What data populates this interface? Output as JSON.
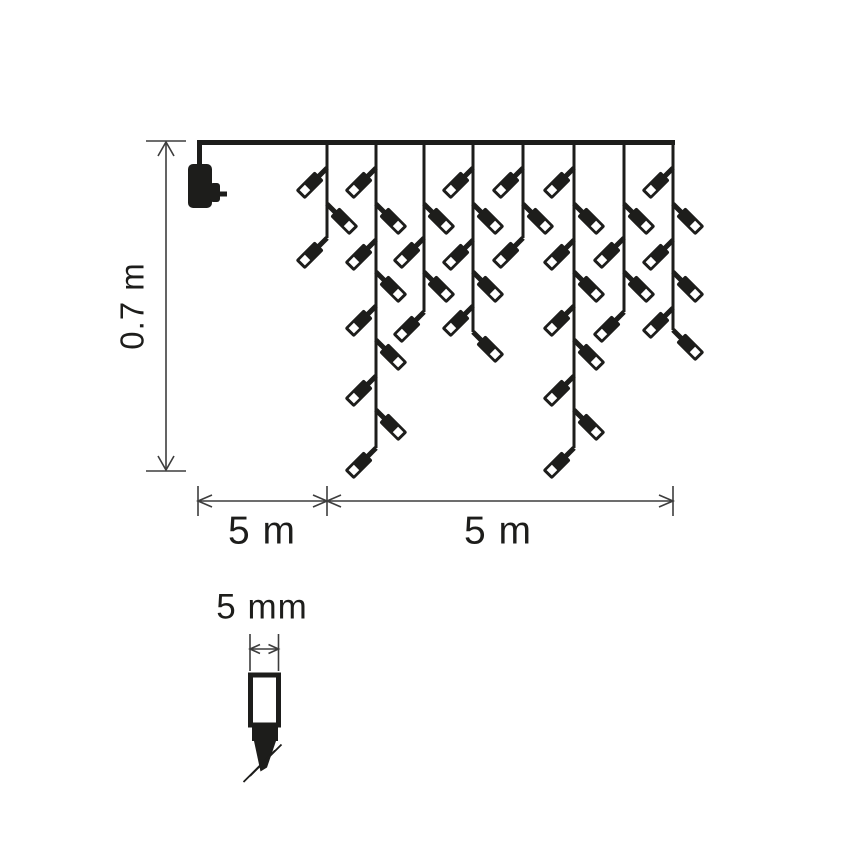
{
  "diagram": {
    "type": "product-dimension-diagram",
    "subject": "LED icicle light chain with power adapter",
    "colors": {
      "ink": "#1d1d1b",
      "dimension": "#3d3d3d",
      "background": "#ffffff",
      "bulb_window": "#ffffff"
    },
    "labels": {
      "height": "0.7 m",
      "lead_length": "5 m",
      "lit_length": "5 m",
      "bulb_width": "5 mm"
    },
    "counts": {
      "drops": 8,
      "bulbs_total": 44
    },
    "top_wire": {
      "x1": 197,
      "x2": 675,
      "y": 142.5,
      "thickness": 5
    },
    "power_adapter": {
      "lead": {
        "x": 199.5,
        "y1": 140,
        "y2": 166,
        "thickness": 5
      },
      "body": {
        "x": 188,
        "y": 164,
        "w": 24,
        "h": 44,
        "rx": 5
      },
      "bump": {
        "x": 210,
        "y": 183,
        "w": 10,
        "h": 19,
        "rx": 3
      },
      "pin": {
        "x": 219,
        "y": 191.5,
        "w": 8,
        "h": 5
      }
    },
    "drop_line_thickness": 3,
    "bulb_geometry": {
      "angle_left": 135,
      "angle_right": 45,
      "stem": {
        "x": 0,
        "y": -2.5,
        "w": 13,
        "h": 5
      },
      "body": {
        "x": 11,
        "y": -6.5,
        "w": 27,
        "h": 13,
        "rx": 2
      },
      "window": {
        "x": 27.5,
        "y": -3.75,
        "w": 7.5,
        "h": 7.5
      }
    },
    "drops": [
      {
        "x": 327,
        "end": 238,
        "bulbs": [
          [
            "L",
            168
          ],
          [
            "R",
            204
          ],
          [
            "L",
            238
          ]
        ]
      },
      {
        "x": 376,
        "end": 448,
        "bulbs": [
          [
            "L",
            168
          ],
          [
            "R",
            204
          ],
          [
            "L",
            240
          ],
          [
            "R",
            272
          ],
          [
            "L",
            306
          ],
          [
            "R",
            340
          ],
          [
            "L",
            376
          ],
          [
            "R",
            410
          ],
          [
            "L",
            448
          ]
        ]
      },
      {
        "x": 424,
        "end": 312,
        "bulbs": [
          [
            "R",
            204
          ],
          [
            "L",
            238
          ],
          [
            "R",
            272
          ],
          [
            "L",
            312
          ]
        ]
      },
      {
        "x": 473,
        "end": 332,
        "bulbs": [
          [
            "L",
            168
          ],
          [
            "R",
            204
          ],
          [
            "L",
            240
          ],
          [
            "R",
            272
          ],
          [
            "L",
            306
          ],
          [
            "R",
            332
          ]
        ]
      },
      {
        "x": 523,
        "end": 238,
        "bulbs": [
          [
            "L",
            168
          ],
          [
            "R",
            204
          ],
          [
            "L",
            238
          ]
        ]
      },
      {
        "x": 574,
        "end": 448,
        "bulbs": [
          [
            "L",
            168
          ],
          [
            "R",
            204
          ],
          [
            "L",
            240
          ],
          [
            "R",
            272
          ],
          [
            "L",
            306
          ],
          [
            "R",
            340
          ],
          [
            "L",
            376
          ],
          [
            "R",
            410
          ],
          [
            "L",
            448
          ]
        ]
      },
      {
        "x": 624,
        "end": 312,
        "bulbs": [
          [
            "R",
            204
          ],
          [
            "L",
            238
          ],
          [
            "R",
            272
          ],
          [
            "L",
            312
          ]
        ]
      },
      {
        "x": 673,
        "end": 330,
        "bulbs": [
          [
            "L",
            168
          ],
          [
            "R",
            204
          ],
          [
            "L",
            240
          ],
          [
            "R",
            272
          ],
          [
            "L",
            308
          ],
          [
            "R",
            330
          ]
        ]
      }
    ],
    "height_dimension": {
      "x": 166,
      "y1": 142,
      "y2": 470,
      "tick_x1": 146,
      "tick_x2": 186,
      "label_cx": 132,
      "label_cy": 306
    },
    "span_dimension": {
      "y": 501,
      "x1": 198,
      "x_mid": 327,
      "x2": 673,
      "tick_y1": 486,
      "tick_y2": 516,
      "label1_cx": 262,
      "label2_cx": 498,
      "label_cy": 531
    },
    "detail": {
      "label_cx": 262,
      "label_cy": 607,
      "tick_x1": 250,
      "tick_x2": 278.5,
      "tick_y1": 634,
      "tick_y2": 671,
      "arrow_y": 649,
      "body": {
        "x": 250.5,
        "y": 675,
        "w": 28,
        "h": 50,
        "stroke_w": 5
      },
      "collar": {
        "x": 252,
        "y": 727,
        "w": 26,
        "h": 14
      },
      "tip_points": "254,741 276,741 267,767.5 260.5,771.5",
      "wires": [
        [
          250,
          776,
          281.5,
          744.5
        ],
        [
          243.5,
          782,
          275,
          750.5
        ]
      ]
    }
  }
}
